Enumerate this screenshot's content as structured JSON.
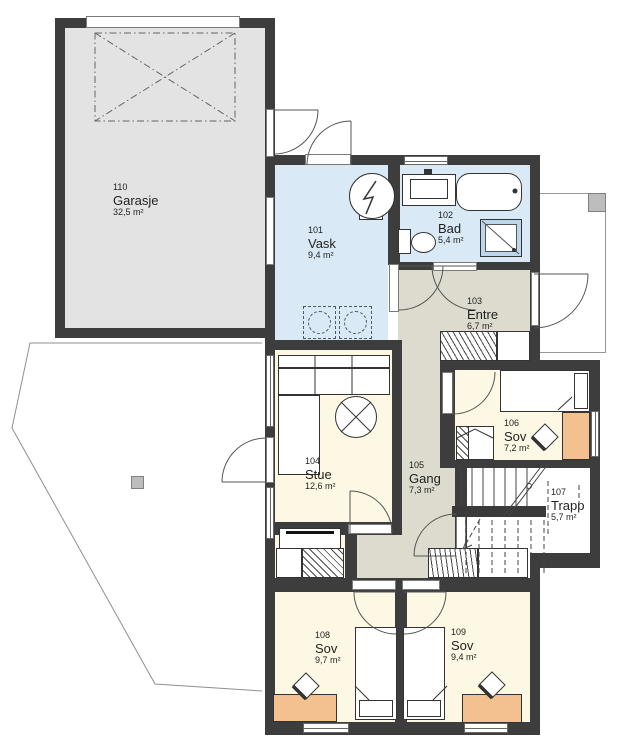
{
  "plan": {
    "type": "floor-plan",
    "language": "Norwegian",
    "rooms": [
      {
        "number": "110",
        "name": "Garasje",
        "area": "32,5 m²"
      },
      {
        "number": "101",
        "name": "Vask",
        "area": "9,4 m²"
      },
      {
        "number": "102",
        "name": "Bad",
        "area": "5,4 m²"
      },
      {
        "number": "103",
        "name": "Entre",
        "area": "6,7 m²"
      },
      {
        "number": "104",
        "name": "Stue",
        "area": "12,6 m²"
      },
      {
        "number": "105",
        "name": "Gang",
        "area": "7,3 m²"
      },
      {
        "number": "106",
        "name": "Sov",
        "area": "7,2 m²"
      },
      {
        "number": "107",
        "name": "Trapp",
        "area": "5,7 m²"
      },
      {
        "number": "108",
        "name": "Sov",
        "area": "9,7 m²"
      },
      {
        "number": "109",
        "name": "Sov",
        "area": "9,4 m²"
      }
    ],
    "colors": {
      "wall": "#3d3d3d",
      "garage_floor": "#e3e3e3",
      "wet_room_floor": "#d9e9f5",
      "hall_floor": "#dcdbce",
      "living_floor": "#fcf8e3",
      "desk": "#f3c08f",
      "outline": "#979797"
    }
  }
}
